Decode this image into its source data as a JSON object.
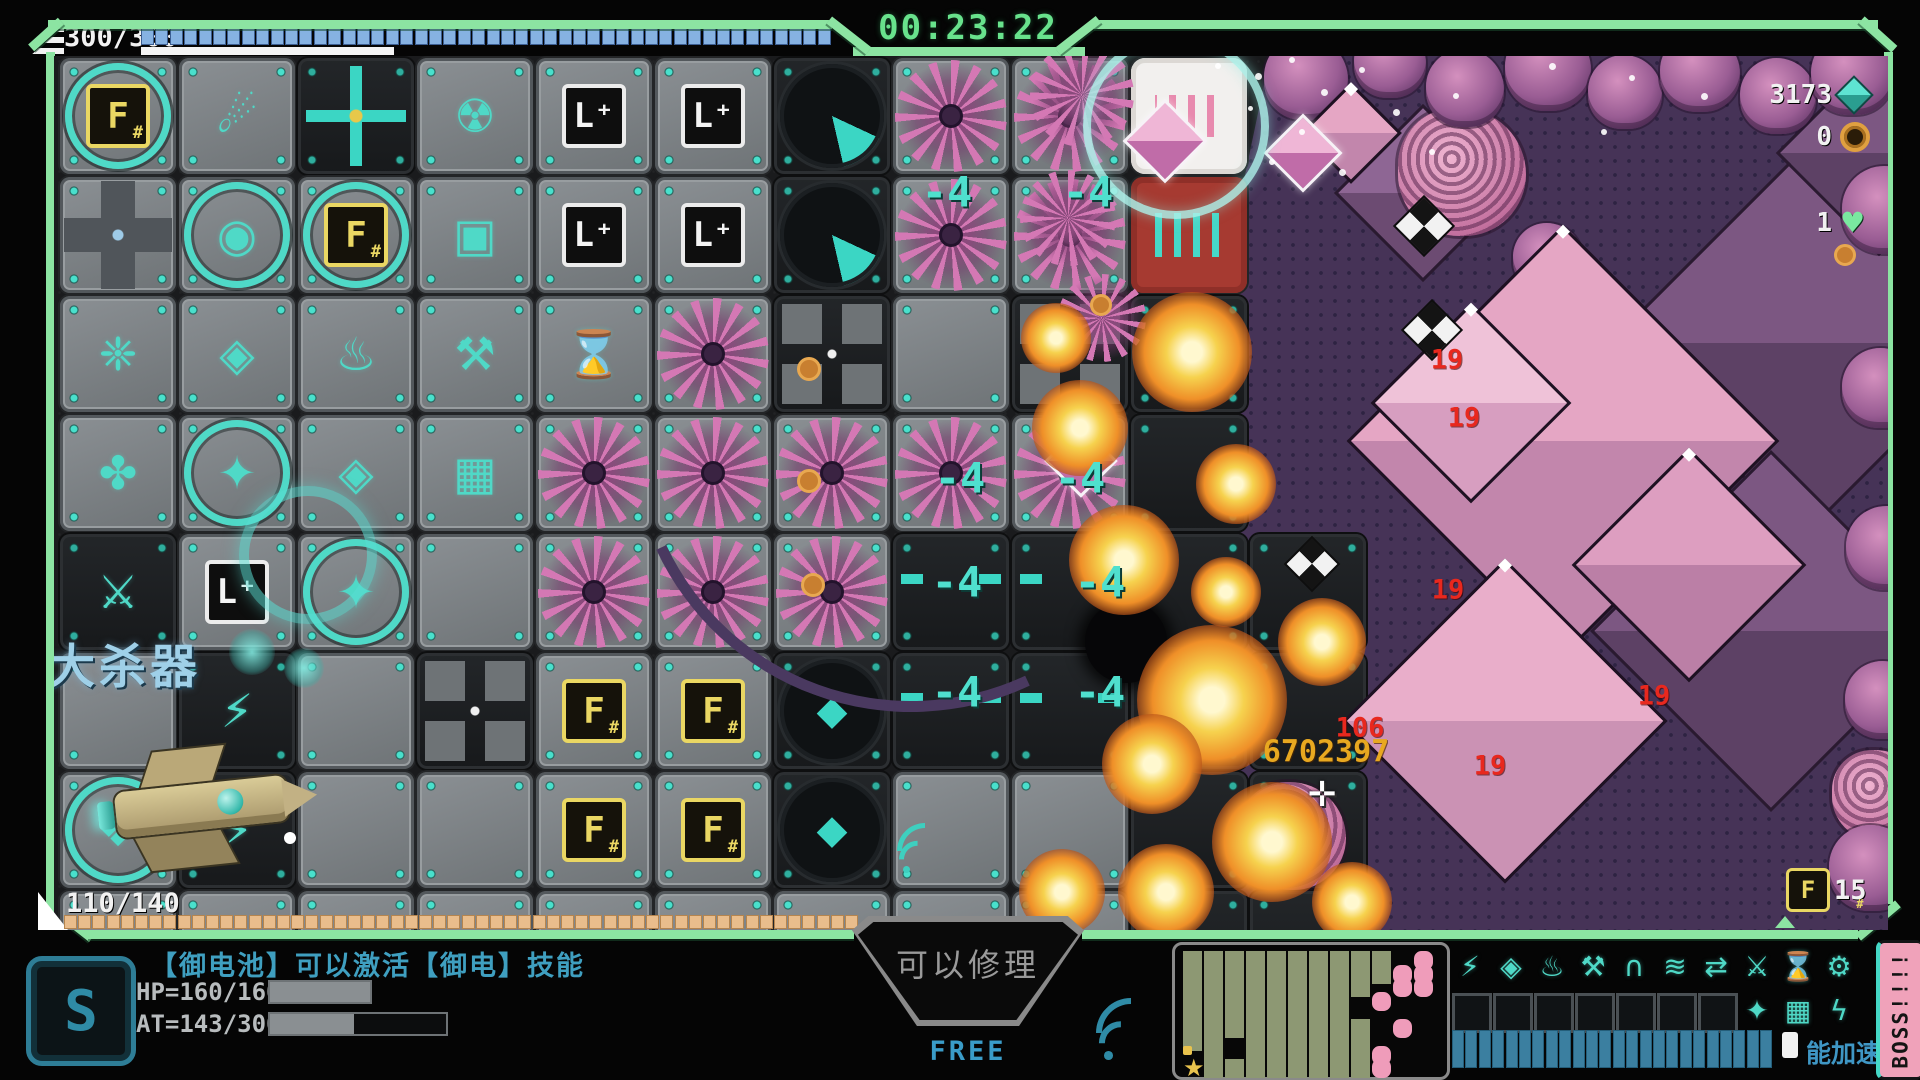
{
  "hud": {
    "timer": "00:23:22",
    "shield_counter": "300/300",
    "shield_segments": 48,
    "hull_counter": "110/140",
    "hull_segments": 56,
    "stats": [
      {
        "name": "crystal-resource",
        "icon": "teal-gem-icon",
        "value": "3173"
      },
      {
        "name": "coin-resource",
        "icon": "orange-coin-icon",
        "value": "0"
      },
      {
        "name": "lives",
        "icon": "green-heart-icon",
        "value": "1"
      }
    ],
    "resource_count": "15",
    "float_text": "获得大杀器",
    "hint": "【御电池】可以激活【御电】技能",
    "hp_label": "HP=160/160",
    "hp_pct": 100,
    "at_label": "AT=143/300",
    "at_pct": 48,
    "repair_label": "可以修理",
    "free_label": "FREE",
    "energy_label": "能加速",
    "boss_label": "BOSS!!!!",
    "core_glyph": "S"
  },
  "colors": {
    "frame_green": "#8ce4a2",
    "teal_accent": "#45d8c6",
    "enemy_pink": "#e5a6c4",
    "damage_red": "#e8281e",
    "damage_yellow": "#e8a820",
    "purple_zone": "#463357"
  },
  "grid": {
    "origin": [
      60,
      58
    ],
    "pitch": 119,
    "rows": [
      [
        "F",
        "comet",
        "crossT",
        "rad",
        "L",
        "L",
        "dial",
        "flower",
        "flower",
        "white"
      ],
      [
        "pipe",
        "gear",
        "F",
        "cube",
        "L",
        "L",
        "dial",
        "flower",
        "flower",
        "red"
      ],
      [
        "claw",
        "core",
        "flame",
        "wrench",
        "hour",
        "flower",
        "crossD",
        "plain",
        "crossD",
        "darkT"
      ],
      [
        "shield",
        "star",
        "core",
        "matrix",
        "flower",
        "flower",
        "flower",
        "flower",
        "flower",
        "darkT"
      ],
      [
        "sword",
        "L",
        "starT",
        "plain",
        "flower",
        "flower",
        "flower",
        "num4",
        "num4",
        "darkT"
      ],
      [
        "plain",
        "bolt",
        "plain",
        "crossD",
        "Fs",
        "Fs",
        "dialD",
        "num4",
        "num4",
        "darkT"
      ],
      [
        "clover",
        "boltD",
        "plain",
        "plain",
        "Fs",
        "Fs",
        "dialD",
        "plain",
        "plain",
        "darkT"
      ],
      [
        "plain",
        "plain",
        "plain",
        "plain",
        "plain",
        "plain",
        "plain",
        "plain",
        "plain",
        "darkT"
      ]
    ],
    "extra": [
      {
        "c": 10,
        "r": 4,
        "t": "darkT"
      },
      {
        "c": 10,
        "r": 5,
        "t": "darkT"
      },
      {
        "c": 10,
        "r": 6,
        "t": "darkT"
      },
      {
        "c": 10,
        "r": 7,
        "t": "darkT"
      }
    ],
    "tile_glyphs": {
      "comet": "☄",
      "rad": "☢",
      "cube": "▣",
      "claw": "❈",
      "core": "◈",
      "flame": "♨",
      "wrench": "⚒",
      "hour": "⌛",
      "matrix": "▦",
      "star": "✦",
      "starT": "✦",
      "shield": "✤",
      "sword": "⚔",
      "bolt": "⚡",
      "boltD": "⚡",
      "clover": "❖",
      "gear": "◉",
      "dialD": "◆"
    },
    "tile_names": {
      "F": "machine-f-core",
      "Fs": "machine-f-module",
      "L": "machine-l-module",
      "dial": "machine-dial",
      "dialD": "machine-diamond-dial",
      "crossT": "conveyor-cross-teal",
      "crossD": "conveyor-cross",
      "pipe": "pipe-junction",
      "comet": "machine-comet",
      "rad": "machine-radiation",
      "gear": "machine-gear",
      "cube": "machine-cube",
      "claw": "machine-claw",
      "core": "machine-prism",
      "flame": "machine-flame",
      "wrench": "machine-repair",
      "hour": "machine-hourglass",
      "matrix": "machine-matrix",
      "star": "machine-star",
      "starT": "machine-star-selected",
      "shield": "machine-shield-pods",
      "sword": "machine-blade",
      "bolt": "machine-bolt",
      "boltD": "machine-bolt-dark",
      "clover": "machine-clover",
      "num4": "floor-damage-tile",
      "darkT": "floor-dark-tile",
      "plain": "floor-plate",
      "flower": "enemy-flower",
      "white": "sound-emitter-white",
      "red": "sound-emitter-red"
    }
  },
  "sprites": [
    {
      "k": "diaB",
      "x": 1420,
      "y": 190,
      "s": 120,
      "c1": "#8e6694",
      "c2": "#6c4b72"
    },
    {
      "k": "diaB",
      "x": 1800,
      "y": 340,
      "s": 270,
      "c1": "#7c5782",
      "c2": "#5d4165"
    },
    {
      "k": "diaB",
      "x": 1768,
      "y": 628,
      "s": 250,
      "c1": "#7c5782",
      "c2": "#5d4165"
    },
    {
      "k": "diaB",
      "x": 1876,
      "y": 150,
      "s": 140,
      "c1": "#7c5782",
      "c2": "#5d4165"
    },
    {
      "k": "brain",
      "x": 1462,
      "y": 172,
      "s": 128
    },
    {
      "k": "brain",
      "x": 1292,
      "y": 836,
      "s": 108
    },
    {
      "k": "brain",
      "x": 1877,
      "y": 795,
      "s": 90
    },
    {
      "k": "flowerL",
      "x": 1082,
      "y": 95,
      "s": 104
    },
    {
      "k": "flowerL",
      "x": 1068,
      "y": 218,
      "s": 96
    },
    {
      "k": "flowerL",
      "x": 1102,
      "y": 318,
      "s": 88
    },
    {
      "k": "crab",
      "x": 1306,
      "y": 78,
      "s": 84
    },
    {
      "k": "crab",
      "x": 1390,
      "y": 62,
      "s": 72
    },
    {
      "k": "crab",
      "x": 1465,
      "y": 88,
      "s": 78
    },
    {
      "k": "crab",
      "x": 1548,
      "y": 68,
      "s": 86
    },
    {
      "k": "crab",
      "x": 1625,
      "y": 92,
      "s": 74
    },
    {
      "k": "crab",
      "x": 1700,
      "y": 72,
      "s": 80
    },
    {
      "k": "crab",
      "x": 1778,
      "y": 96,
      "s": 76
    },
    {
      "k": "crab",
      "x": 1852,
      "y": 74,
      "s": 82
    },
    {
      "k": "crab",
      "x": 1886,
      "y": 210,
      "s": 88
    },
    {
      "k": "crab",
      "x": 1882,
      "y": 388,
      "s": 80
    },
    {
      "k": "crab",
      "x": 1888,
      "y": 548,
      "s": 84
    },
    {
      "k": "crab",
      "x": 1884,
      "y": 700,
      "s": 78
    },
    {
      "k": "crab",
      "x": 1872,
      "y": 868,
      "s": 86
    },
    {
      "k": "crab",
      "x": 1548,
      "y": 258,
      "s": 70
    },
    {
      "k": "dia",
      "x": 1560,
      "y": 438,
      "s": 300,
      "c1": "#e5a6c4",
      "c2": "#c286ac"
    },
    {
      "k": "dia",
      "x": 1502,
      "y": 718,
      "s": 224,
      "c1": "#e9aeca",
      "c2": "#cb92b4"
    },
    {
      "k": "dia",
      "x": 1468,
      "y": 400,
      "s": 136,
      "c1": "#efc2d8",
      "c2": "#d79ec0"
    },
    {
      "k": "dia",
      "x": 1686,
      "y": 562,
      "s": 160,
      "c1": "#dd9ec0",
      "c2": "#bb7fa6"
    },
    {
      "k": "dia",
      "x": 1348,
      "y": 130,
      "s": 66,
      "c1": "#e5a6c4",
      "c2": "#c286ac"
    },
    {
      "k": "gem",
      "x": 1078,
      "y": 458,
      "s": 46
    },
    {
      "k": "gem",
      "x": 1162,
      "y": 138,
      "s": 54
    },
    {
      "k": "gem",
      "x": 1300,
      "y": 150,
      "s": 50
    },
    {
      "k": "pin",
      "x": 1422,
      "y": 224,
      "s": 40
    },
    {
      "k": "pin",
      "x": 1430,
      "y": 328,
      "s": 40
    },
    {
      "k": "pin",
      "x": 1310,
      "y": 562,
      "s": 36
    },
    {
      "k": "dotO",
      "x": 806,
      "y": 366,
      "s": 18
    },
    {
      "k": "dotO",
      "x": 806,
      "y": 478,
      "s": 18
    },
    {
      "k": "dotO",
      "x": 810,
      "y": 582,
      "s": 18
    },
    {
      "k": "dotO",
      "x": 1098,
      "y": 302,
      "s": 16
    },
    {
      "k": "dotO",
      "x": 1842,
      "y": 252,
      "s": 16
    },
    {
      "k": "hole",
      "x": 1126,
      "y": 642,
      "s": 82
    },
    {
      "k": "arc",
      "x": 900,
      "y": 420,
      "s": 540,
      "rot": 200
    },
    {
      "k": "boom",
      "x": 1192,
      "y": 352,
      "s": 120
    },
    {
      "k": "boom",
      "x": 1080,
      "y": 428,
      "s": 96
    },
    {
      "k": "boom",
      "x": 1124,
      "y": 560,
      "s": 110
    },
    {
      "k": "boom",
      "x": 1212,
      "y": 700,
      "s": 150
    },
    {
      "k": "boom",
      "x": 1152,
      "y": 764,
      "s": 100
    },
    {
      "k": "boom",
      "x": 1272,
      "y": 842,
      "s": 120
    },
    {
      "k": "boom",
      "x": 1322,
      "y": 642,
      "s": 88
    },
    {
      "k": "boom",
      "x": 1236,
      "y": 484,
      "s": 80
    },
    {
      "k": "boom",
      "x": 1056,
      "y": 338,
      "s": 70
    },
    {
      "k": "boom",
      "x": 1166,
      "y": 892,
      "s": 96
    },
    {
      "k": "boom",
      "x": 1352,
      "y": 902,
      "s": 80
    },
    {
      "k": "boom",
      "x": 1062,
      "y": 892,
      "s": 86
    },
    {
      "k": "boom",
      "x": 1226,
      "y": 592,
      "s": 70
    },
    {
      "k": "bubble",
      "x": 1168,
      "y": 118,
      "s": 170
    },
    {
      "k": "ring",
      "x": 298,
      "y": 545,
      "s": 118
    },
    {
      "k": "glow",
      "x": 252,
      "y": 652,
      "s": 46
    },
    {
      "k": "glow",
      "x": 304,
      "y": 668,
      "s": 40
    },
    {
      "k": "dotW",
      "x": 290,
      "y": 838,
      "s": 12
    },
    {
      "k": "wifi",
      "x": 920,
      "y": 856,
      "s": 46
    },
    {
      "k": "spark",
      "x": 1258,
      "y": 76,
      "s": 7
    },
    {
      "k": "spark",
      "x": 1292,
      "y": 60,
      "s": 6
    },
    {
      "k": "spark",
      "x": 1324,
      "y": 92,
      "s": 7
    },
    {
      "k": "spark",
      "x": 1362,
      "y": 70,
      "s": 6
    },
    {
      "k": "spark",
      "x": 1396,
      "y": 112,
      "s": 7
    },
    {
      "k": "spark",
      "x": 1302,
      "y": 132,
      "s": 6
    },
    {
      "k": "spark",
      "x": 1272,
      "y": 162,
      "s": 6
    },
    {
      "k": "spark",
      "x": 1342,
      "y": 172,
      "s": 7
    },
    {
      "k": "spark",
      "x": 1432,
      "y": 152,
      "s": 6
    },
    {
      "k": "spark",
      "x": 1456,
      "y": 96,
      "s": 6
    },
    {
      "k": "spark",
      "x": 1552,
      "y": 66,
      "s": 7
    },
    {
      "k": "spark",
      "x": 1632,
      "y": 78,
      "s": 6
    },
    {
      "k": "spark",
      "x": 1704,
      "y": 96,
      "s": 7
    },
    {
      "k": "spark",
      "x": 1604,
      "y": 132,
      "s": 6
    },
    {
      "k": "spark",
      "x": 1250,
      "y": 108,
      "s": 5
    },
    {
      "k": "spark",
      "x": 1218,
      "y": 66,
      "s": 6
    }
  ],
  "sprite_names": {
    "dia": "enemy-crystal",
    "diaB": "enemy-crystal-far",
    "gem": "pickup-gem",
    "pin": "pickup-pinwheel",
    "crab": "enemy-crab",
    "brain": "enemy-brain",
    "flowerL": "enemy-flower",
    "boom": "explosion-effect",
    "hole": "crater",
    "arc": "trajectory-arc",
    "bubble": "shield-bubble",
    "ring": "target-ring",
    "glow": "engine-glow",
    "dotO": "pickup-orb",
    "dotW": "tracer-dot",
    "spark": "sparkle",
    "wifi": "signal-icon"
  },
  "labels": [
    {
      "x": 947,
      "y": 192,
      "t": "-4",
      "cls": "dmg-teal",
      "name": "damage-number"
    },
    {
      "x": 1088,
      "y": 192,
      "t": "-4",
      "cls": "dmg-teal",
      "name": "damage-number"
    },
    {
      "x": 960,
      "y": 478,
      "t": "-4",
      "cls": "dmg-teal",
      "name": "damage-number"
    },
    {
      "x": 1080,
      "y": 478,
      "t": "-4",
      "cls": "dmg-teal",
      "name": "damage-number"
    },
    {
      "x": 957,
      "y": 582,
      "t": "-4",
      "cls": "dmg-teal",
      "name": "damage-number"
    },
    {
      "x": 1100,
      "y": 582,
      "t": "-4",
      "cls": "dmg-teal",
      "name": "damage-number"
    },
    {
      "x": 957,
      "y": 692,
      "t": "-4",
      "cls": "dmg-teal",
      "name": "damage-number"
    },
    {
      "x": 1100,
      "y": 692,
      "t": "-4",
      "cls": "dmg-teal",
      "name": "damage-number"
    },
    {
      "x": 1447,
      "y": 360,
      "t": "19",
      "cls": "dmg-red",
      "name": "damage-number"
    },
    {
      "x": 1464,
      "y": 418,
      "t": "19",
      "cls": "dmg-red",
      "name": "damage-number"
    },
    {
      "x": 1448,
      "y": 590,
      "t": "19",
      "cls": "dmg-red",
      "name": "damage-number"
    },
    {
      "x": 1654,
      "y": 696,
      "t": "19",
      "cls": "dmg-red",
      "name": "damage-number"
    },
    {
      "x": 1490,
      "y": 766,
      "t": "19",
      "cls": "dmg-red",
      "name": "damage-number"
    },
    {
      "x": 1360,
      "y": 728,
      "t": "106",
      "cls": "dmg-red",
      "name": "damage-number"
    },
    {
      "x": 1326,
      "y": 752,
      "t": "6702397",
      "cls": "dmg-yellow",
      "name": "damage-number"
    },
    {
      "x": 1322,
      "y": 790,
      "t": "✛",
      "cls": "cursor-g",
      "name": "aim-cursor"
    }
  ],
  "minimap": {
    "rows": [
      "GGGGGGGGGG.P",
      "GGGGGGGGGGPP",
      "GGGGGGGGG.PP",
      "GGGGGGGG.P..",
      "GGGGGGGG....",
      "GGGGGGGGG.P.",
      "GG.GGGGGG...",
      "yG.GGGGGGP..",
      "SGGGGGGGGP.."
    ]
  },
  "skills": {
    "row1": [
      {
        "name": "dash",
        "glyph": "⚡"
      },
      {
        "name": "prism",
        "glyph": "◈"
      },
      {
        "name": "flame",
        "glyph": "♨"
      },
      {
        "name": "repair",
        "glyph": "⚒"
      },
      {
        "name": "dome",
        "glyph": "∩"
      },
      {
        "name": "signal",
        "glyph": "≋"
      },
      {
        "name": "warp",
        "glyph": "⇄"
      },
      {
        "name": "slash",
        "glyph": "⚔"
      },
      {
        "name": "scan",
        "glyph": "⌛"
      },
      {
        "name": "wrench",
        "glyph": "⚙"
      }
    ],
    "row2_empty": 7,
    "row2": [
      {
        "name": "star",
        "glyph": "✦"
      },
      {
        "name": "matrix",
        "glyph": "▦"
      },
      {
        "name": "bolt",
        "glyph": "ϟ"
      }
    ],
    "energy_segments": 24
  }
}
